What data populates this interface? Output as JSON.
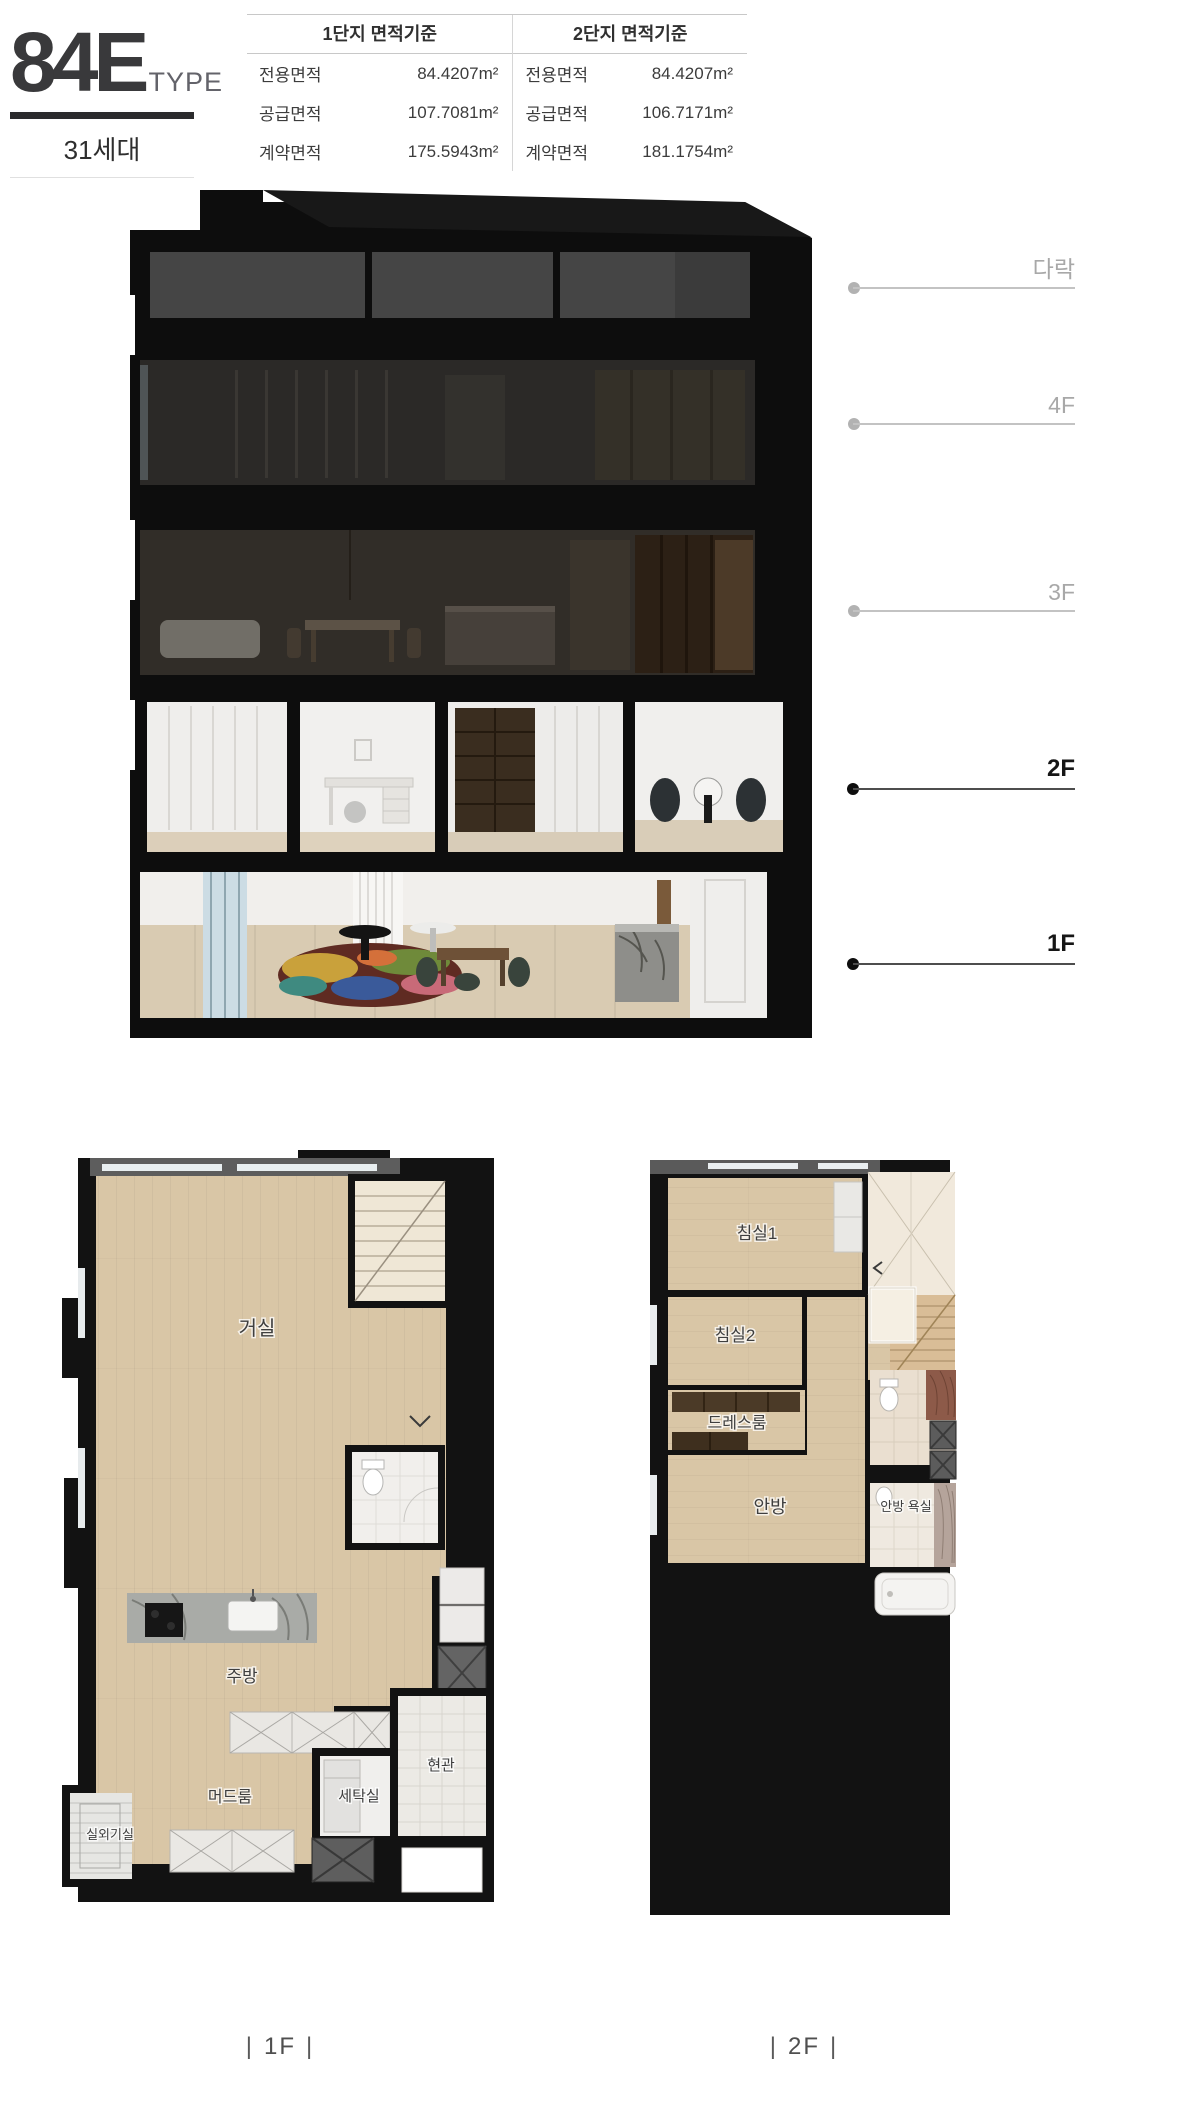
{
  "header": {
    "type_code": "84E",
    "type_label": "TYPE",
    "units_count": "31세대"
  },
  "area_table": {
    "groups": [
      {
        "title": "1단지 면적기준",
        "rows": [
          {
            "label": "전용면적",
            "value": "84.4207m²"
          },
          {
            "label": "공급면적",
            "value": "107.7081m²"
          },
          {
            "label": "계약면적",
            "value": "175.5943m²"
          }
        ]
      },
      {
        "title": "2단지 면적기준",
        "rows": [
          {
            "label": "전용면적",
            "value": "84.4207m²"
          },
          {
            "label": "공급면적",
            "value": "106.7171m²"
          },
          {
            "label": "계약면적",
            "value": "181.1754m²"
          }
        ]
      }
    ]
  },
  "section": {
    "floors": [
      {
        "label": "다락",
        "emphasized": false
      },
      {
        "label": "4F",
        "emphasized": false
      },
      {
        "label": "3F",
        "emphasized": false
      },
      {
        "label": "2F",
        "emphasized": true
      },
      {
        "label": "1F",
        "emphasized": true
      }
    ]
  },
  "plans": {
    "caption_bar": "|",
    "plan_1f": {
      "caption": "1F",
      "labels": {
        "living": "거실",
        "kitchen": "주방",
        "mudroom": "머드룸",
        "laundry": "세탁실",
        "entrance": "현관",
        "outdoor_unit": "실외기실"
      }
    },
    "plan_2f": {
      "caption": "2F",
      "labels": {
        "bedroom1": "침실1",
        "bedroom2": "침실2",
        "dressroom": "드레스룸",
        "master": "안방",
        "master_bath": "안방 욕실"
      }
    }
  },
  "colors": {
    "emphasis_text": "#161616",
    "muted_text": "#a8a8a8",
    "header_rule": "#2b2b2d",
    "wood_floor": "#d9c6a6"
  }
}
